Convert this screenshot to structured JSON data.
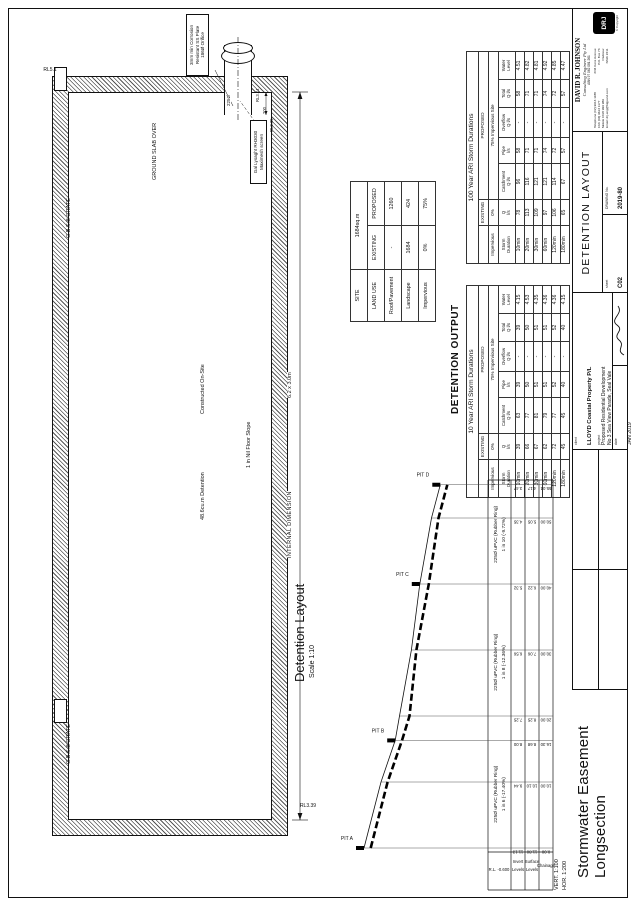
{
  "headings": {
    "detention_output": "DETENTION OUTPUT",
    "detention_layout": "Detention Layout",
    "detention_layout_scale": "Scale 1:10",
    "longsection_line1": "Stormwater Easement",
    "longsection_line2": "Longsection",
    "scale_note_line1": "VERT. 1:100",
    "scale_note_line2": "HOR. 1:200"
  },
  "plan": {
    "ground_slab": "GROUND SLAB OVER",
    "volume": "48.6cu.m Detention",
    "constructed": "Constructed On-Site",
    "floor_slope": "1 in Nil Floor Slope",
    "internal_dim_label": "INTERNAL DIMENSION",
    "internal_dim_value": "6.2 x 3.0m",
    "grate_left": "G.B.S.B GRATE",
    "grate_right": "G.B.S.B GRATE",
    "rl_grate": "RL5.1",
    "rl_floor": "RL3.39",
    "rl_pipe_top": "RL3.44",
    "rl_pipe_invert": "RL3.35",
    "pipe_dia": "225Ø",
    "dim_200": "200",
    "orifice_note": [
      "3mm min Corrosion",
      "Resistant SS Plate",
      "186Ø Orifice"
    ],
    "screen_note": [
      "Gal Lysaght RH3030",
      "Maximesh screen"
    ]
  },
  "site_table": {
    "site_label": "SITE",
    "site_value": "1684sq.m",
    "land_use": "LAND USE",
    "existing": "EXISTING",
    "proposed": "PROPOSED",
    "rows": [
      [
        "Roof/Pavement",
        "-",
        "1260"
      ],
      [
        "Landscape",
        "1684",
        "424"
      ],
      [
        "Impervious",
        "0%",
        "75%"
      ]
    ]
  },
  "storm_header": {
    "existing": "EXISTING",
    "proposed": "PROPOSED",
    "impervious": "Impervious",
    "imp_existing": "0%",
    "imp_proposed": "75% Impervious Site",
    "cols": [
      "Storm\nDuration",
      "Q\nl/s",
      "Catchment\nQ l/s",
      "Pipe\nl/s",
      "Overflow\nQ l/s",
      "Total\nQ l/s",
      "Water\nLevel"
    ]
  },
  "storm_tables": [
    {
      "title": "10 Year ARI Storm Durations",
      "rows": [
        [
          "10min",
          "39",
          "63",
          "39",
          "-",
          "39",
          "4.15"
        ],
        [
          "20min",
          "66",
          "77",
          "50",
          "-",
          "50",
          "4.53"
        ],
        [
          "30min",
          "67",
          "81",
          "51",
          "-",
          "51",
          "4.35"
        ],
        [
          "60min",
          "62",
          "79",
          "51",
          "-",
          "51",
          "4.36"
        ],
        [
          "120min",
          "72",
          "77",
          "52",
          "-",
          "52",
          "4.36"
        ],
        [
          "180min",
          "45",
          "45",
          "40",
          "-",
          "40",
          "4.15"
        ]
      ]
    },
    {
      "title": "100 Year ARI Storm Durations",
      "rows": [
        [
          "10min",
          "78",
          "96",
          "58",
          "-",
          "58",
          "4.51"
        ],
        [
          "20min",
          "113",
          "116",
          "71",
          "-",
          "71",
          "4.82"
        ],
        [
          "30min",
          "109",
          "121",
          "71",
          "-",
          "71",
          "4.81"
        ],
        [
          "60min",
          "97",
          "121",
          "74",
          "-",
          "74",
          "4.92"
        ],
        [
          "120min",
          "106",
          "114",
          "72",
          "-",
          "72",
          "4.85"
        ],
        [
          "180min",
          "65",
          "67",
          "57",
          "-",
          "57",
          "4.47"
        ]
      ]
    }
  ],
  "longsection": {
    "datum": "R.L. -0.600",
    "row_labels": [
      [
        "Invert",
        "Levels"
      ],
      [
        "Surface",
        "Levels"
      ],
      [
        "Chainage"
      ]
    ],
    "points": [
      {
        "ch": "0.00",
        "invert": "11.13",
        "surface": "11.80"
      },
      {
        "ch": "10.00",
        "invert": "9.44",
        "surface": "10.10"
      },
      {
        "ch": "16.30",
        "invert": "8.00",
        "surface": "8.68"
      },
      {
        "ch": "20.00",
        "invert": "7.25",
        "surface": "8.25"
      },
      {
        "ch": "30.00",
        "invert": "6.56",
        "surface": "7.06"
      },
      {
        "ch": "40.00",
        "invert": "5.32",
        "surface": "6.22"
      },
      {
        "ch": "50.00",
        "invert": "4.35",
        "surface": "5.05"
      },
      {
        "ch": "55.04",
        "invert": "3.47",
        "surface": "4.17"
      }
    ],
    "pits": [
      {
        "label": "PIT A",
        "ch": "0.00"
      },
      {
        "label": "PIT B",
        "ch": "16.30"
      },
      {
        "label": "PIT C",
        "ch": "40.00"
      },
      {
        "label": "PIT D",
        "ch": "55.04"
      }
    ],
    "sections": [
      {
        "from": "0.00",
        "to": "16.30",
        "pipe": "225Ø uPVC (Rubber Ring)",
        "grade": "1 in 6  (-17.40%)"
      },
      {
        "from": "16.30",
        "to": "40.00",
        "pipe": "225Ø uPVC (Rubber Ring)",
        "grade": "1 in 8  (-12.36%)"
      },
      {
        "from": "40.00",
        "to": "55.04",
        "pipe": "225Ø uPVC (Rubber Ring)",
        "grade": "1 in 10  (-9.72%)"
      }
    ]
  },
  "title_block": {
    "client_label": "client",
    "client": "LLOYD Coastal Property P/L",
    "project_label": "project",
    "project": "Proposed Residential Development",
    "address": "No 3 Sea View Parade, Seal Vale",
    "date_label": "date",
    "date": "JAN 2019",
    "sheet_label": "sheet",
    "sheet": "C02",
    "drawing_title": "DETENTION LAYOUT",
    "drawing_no_label": "DRAWING No.",
    "drawing_no": "2019-80",
    "company": {
      "name": "DAVID R. JOHNSON",
      "line2": "Consulting Engineer Pty Ltd",
      "abn": "ABN 97 062 081 261",
      "contacts": [
        "Telephone (02) 9613 1188",
        "FAX (02) 9613 1177",
        "Mobile 0418 999 989",
        "Email: drj.eng@bigpond.com"
      ],
      "address": [
        "2/34 Kens Avenue",
        "P.O. Box 73",
        "Padstow",
        "NSW 2211"
      ],
      "logo_text": "DRJ",
      "copyright": "© Copyright"
    }
  }
}
